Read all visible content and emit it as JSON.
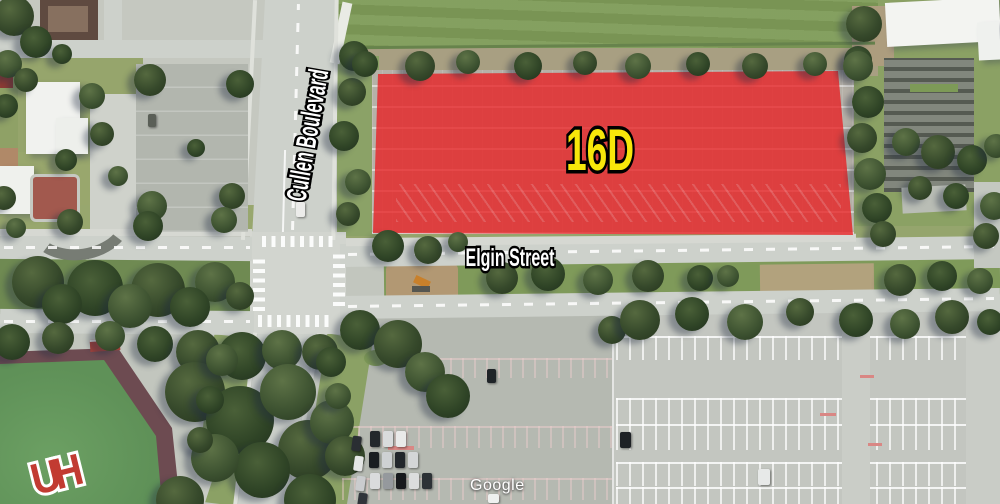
{
  "map": {
    "attribution": "Google",
    "zone": {
      "label": "16D",
      "fill": "#e81f22",
      "opacity": 0.78,
      "label_color": "#f7e70a"
    },
    "streets": {
      "vertical": "Cullen Boulevard",
      "horizontal": "Elgin Street"
    },
    "field_logo": "UH"
  }
}
